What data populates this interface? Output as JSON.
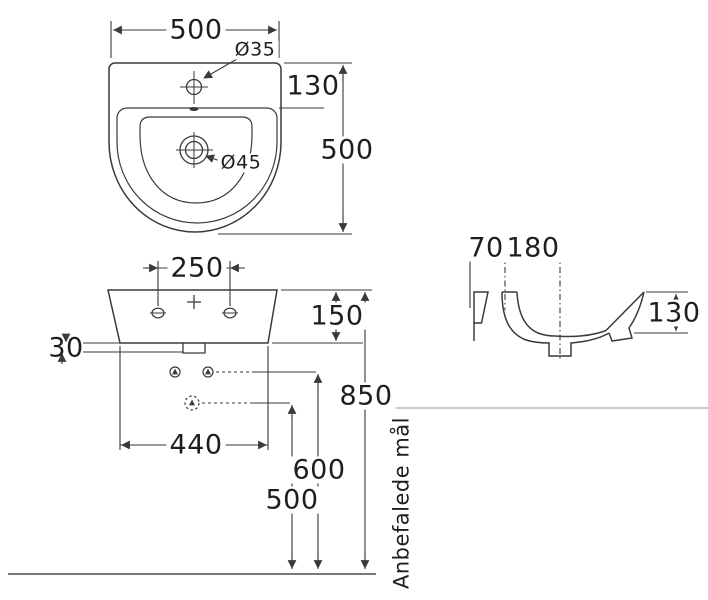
{
  "drawing": {
    "note_vertical": "Anbefalede mål",
    "top_view": {
      "width": "500",
      "tap_hole_diameter": "Ø35",
      "rim_to_bowl": "130",
      "depth": "500",
      "drain_diameter": "Ø45"
    },
    "front_view": {
      "tap_hole_spacing": "250",
      "body_height": "150",
      "lip": "30",
      "fixing_width": "440",
      "rim_height": "850",
      "drain_height": "600",
      "trap_height": "500"
    },
    "side_view": {
      "back_to_fixing": "70",
      "fixing_to_drain": "180",
      "bowl_depth": "130"
    }
  },
  "colors": {
    "line": "#3a3a3a",
    "text": "#1e1e1e",
    "faint_line": "#c9c9c9",
    "floor_line": "#4a4a4a",
    "background": "#ffffff"
  }
}
